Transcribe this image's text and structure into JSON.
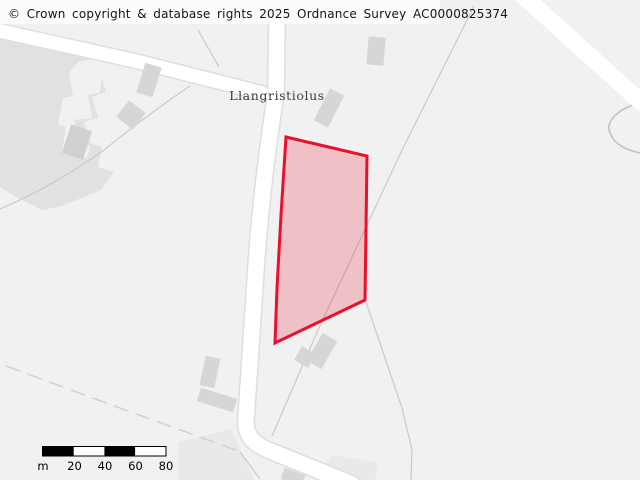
{
  "copyright": {
    "text": "© Crown copyright & database rights 2025 Ordnance Survey AC0000825374"
  },
  "place": {
    "label": "Llangristiolus"
  },
  "parcel": {
    "description": "highlighted land parcel outline",
    "points": "286,137 367,156 365,300 275,343 277,288 281,215",
    "stroke_color": "#e8112d",
    "fill_color": "rgba(232,17,45,0.22)"
  },
  "scale_bar": {
    "unit_label": "m",
    "ticks": [
      "20",
      "40",
      "60",
      "80"
    ]
  },
  "colors": {
    "map_background": "#f1f1f1",
    "road_fill": "#ffffff",
    "building_fill": "#d6d6d6",
    "area_tint": "#e1e1e1",
    "boundary_line": "#c9c9c9",
    "scale_bar_black": "#000000"
  }
}
